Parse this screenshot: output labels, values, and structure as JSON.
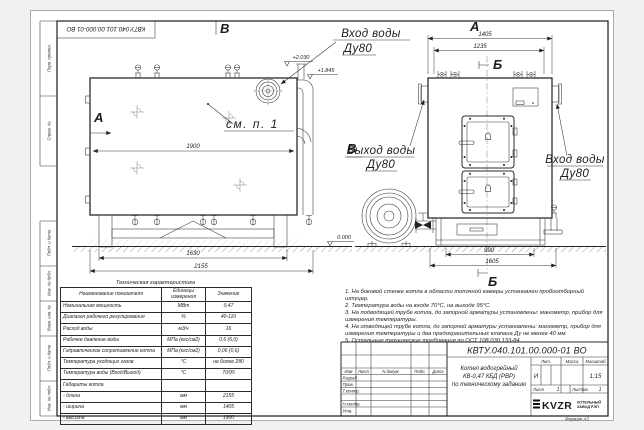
{
  "frame": {
    "top_stamp": "КВТУ.040.101.00.000-01 ВО",
    "margin_labels": [
      "Перв. примен.",
      "Справ. №",
      "Подп. и дата",
      "Инв. № дубл.",
      "Взам. инв. №",
      "Подп. и дата",
      "Инв. № подл."
    ],
    "format_label": "Формат  А3"
  },
  "views": {
    "side": {
      "section_a": "А",
      "view_v": "В",
      "see_note": "см. п. 1",
      "inlet_line1": "Вход воды",
      "inlet_line2": "Ду80",
      "elev_top": "+2.030",
      "elev_duct": "+1.845",
      "elev_zero": "0.000",
      "dim_body": "1900",
      "dim_base": "1630",
      "dim_total": "2155"
    },
    "front": {
      "view_a": "А",
      "section_b": "Б",
      "dim_total": "1405",
      "dim_inner": "1235",
      "dim_base": "990",
      "dim_bottom": "1605",
      "outlet_line1": "Выход воды",
      "outlet_line2": "Ду80",
      "inlet_line1": "Вход воды",
      "inlet_line2": "Ду80"
    }
  },
  "spec_table": {
    "title": "Техническая характеристика",
    "col_headers": [
      "Наименование показателя",
      "Единицы измерения",
      "Значение"
    ],
    "rows": [
      [
        "Номинальная мощность",
        "МВт",
        "0,47"
      ],
      [
        "Диапазон рабочего регулирования",
        "%",
        "40-110"
      ],
      [
        "Расход воды",
        "м3/ч",
        "16"
      ],
      [
        "Рабочее давление воды",
        "МПа (кгс/см2)",
        "0,6 (6,0)"
      ],
      [
        "Гидравлическое сопротивление котла",
        "МПа (кгс/см2)",
        "0,06 (0,6)"
      ],
      [
        "Температура уходящих газов",
        "°С",
        "не более 280"
      ],
      [
        "Температура воды (Вход/Выход)",
        "°С",
        "70/95"
      ],
      [
        "Габариты котла",
        "",
        ""
      ],
      [
        "   - длина",
        "мм",
        "2155"
      ],
      [
        "   - ширина",
        "мм",
        "1405"
      ],
      [
        "   - высота",
        "мм",
        "1900"
      ]
    ]
  },
  "notes": {
    "items": [
      "1. На боковой стенке котла в области топочной камеры установлен пробоотборный штуцер.",
      "2. Температура воды на входе 70°С, на выходе 95°С.",
      "3. На подводящей трубе котла, до запорной арматуры установлены: манометр, прибор для измерения температуры.",
      "4. На отводящей трубе котла, до запорной арматуры установлены: манометр, прибор для измерения температуры и два предохранительных клапана Ду не менее 40 мм.",
      "5. Остальные технические требования по ОСТ 108.030.133-84."
    ]
  },
  "title_block": {
    "doc_number": "КВТУ.040.101.00.000-01 ВО",
    "title_lines": [
      "Котел водогрейный",
      "КВ-0,47 КБД (РВР)",
      "по техническому заданию"
    ],
    "col_izm": "Изм",
    "col_list": "Лист",
    "col_doc": "N докум.",
    "col_podp": "Подп.",
    "col_data": "Дата",
    "row_labels": [
      "Разраб.",
      "Пров.",
      "Т.контр.",
      "Н.контр.",
      "Утв."
    ],
    "lit_label": "Лит.",
    "lit_value": "И",
    "mass_label": "Масса",
    "scale_label": "Масштаб",
    "scale_value": "1:15",
    "sheet_label": "Лист",
    "sheet_value": "1",
    "sheets_label": "Листов",
    "sheets_value": "1",
    "logo_text": "KVZR",
    "company_line1": "КОТЕЛЬНЫЙ",
    "company_line2": "ЗАВОД РЭП"
  }
}
